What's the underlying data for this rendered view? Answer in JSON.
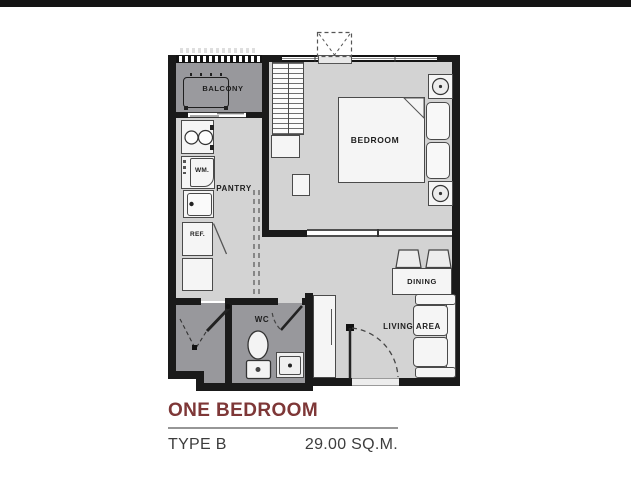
{
  "page": {
    "top_bar_color": "#141414",
    "background": "#ffffff"
  },
  "plan": {
    "labels": {
      "balcony": "BALCONY",
      "pantry": "PANTRY",
      "bedroom": "BEDROOM",
      "wm": "WM.",
      "ref": "REF.",
      "wc": "WC",
      "dining": "DINING",
      "living_area": "LIVING AREA"
    },
    "colors": {
      "wall": "#1a1a1a",
      "floor_main": "#d3d3d3",
      "floor_wet": "#98989c",
      "furniture_fill": "#f5f5f5",
      "outline": "#4a4a4a"
    }
  },
  "caption": {
    "title": "ONE BEDROOM",
    "type_label": "TYPE B",
    "area_label": "29.00 SQ.M.",
    "title_color": "#7e3737",
    "text_color": "#3d3d3d"
  }
}
